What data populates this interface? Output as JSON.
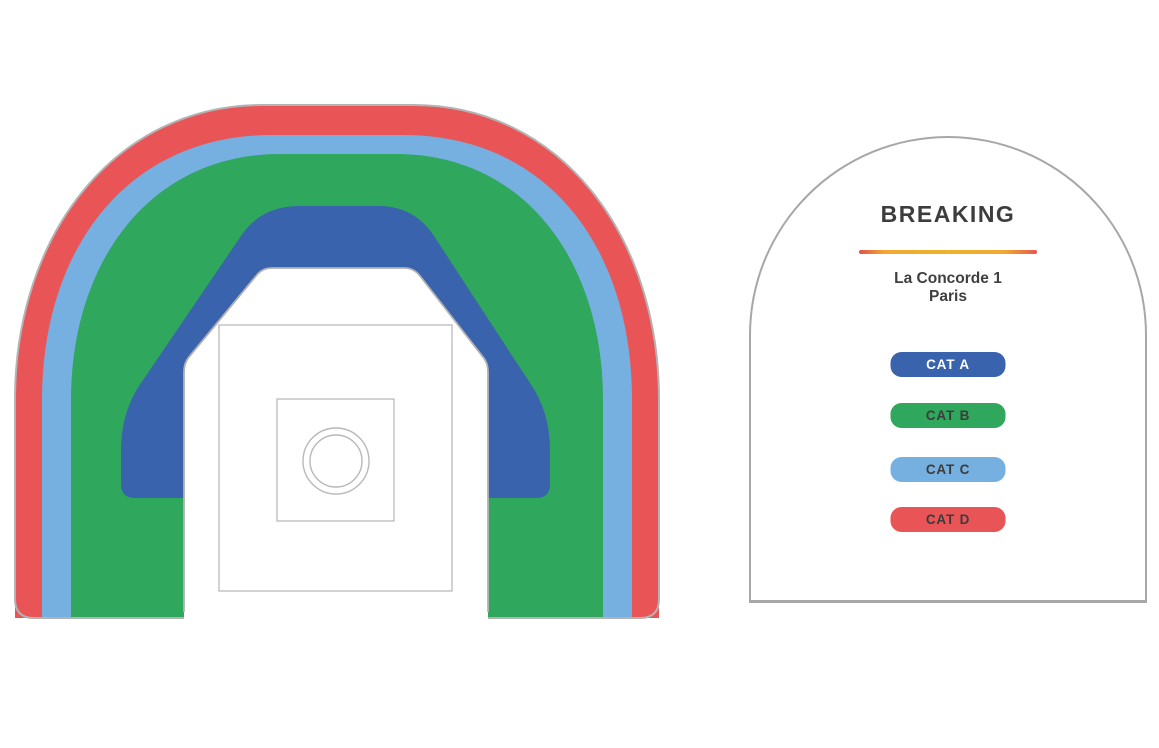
{
  "legend": {
    "title": "BREAKING",
    "venue": "La Concorde 1",
    "city": "Paris",
    "categories": [
      {
        "id": "cat_a",
        "label": "CAT A",
        "color": "#3a63ad",
        "text_color": "#ffffff"
      },
      {
        "id": "cat_b",
        "label": "CAT B",
        "color": "#2fa75c",
        "text_color": "#3c3c3c"
      },
      {
        "id": "cat_c",
        "label": "CAT C",
        "color": "#76b0e0",
        "text_color": "#3c3c3c"
      },
      {
        "id": "cat_d",
        "label": "CAT D",
        "color": "#e95456",
        "text_color": "#3c3c3c"
      }
    ],
    "divider_gradient": [
      "#e2504c",
      "#f0a832",
      "#edb32a",
      "#f0a832",
      "#e8554f"
    ]
  },
  "map": {
    "bands": {
      "cat_a": "#3a63ad",
      "cat_b": "#2fa75c",
      "cat_c": "#76b0e0",
      "cat_d": "#e95456"
    },
    "outline_color": "#b3b3b3",
    "stage_outline_color": "#b9b9b9"
  }
}
